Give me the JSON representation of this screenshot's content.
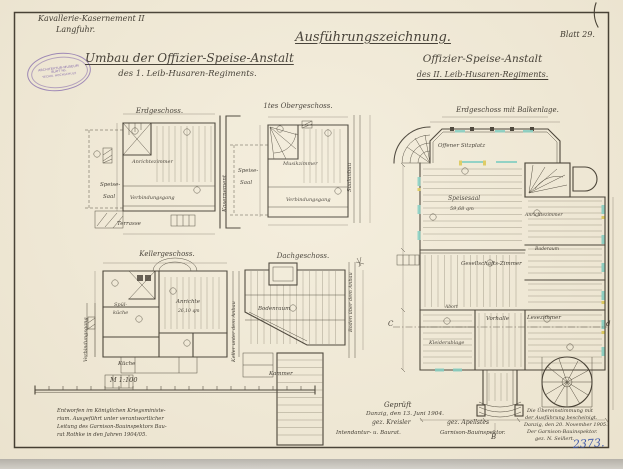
{
  "sheet": {
    "header": {
      "project_line1": "Kavallerie-Kasernement II",
      "project_line2": "Langfuhr.",
      "title_left_line1": "Umbau der Offizier-Speise-Anstalt",
      "title_left_line2": "des 1. Leib-Husaren-Regiments.",
      "main_title": "Ausführungszeichnung.",
      "title_right_line1": "Offizier-Speise-Anstalt",
      "title_right_line2": "des II. Leib-Husaren-Regiments.",
      "sheet_no": "Blatt 29."
    },
    "stamp": {
      "top": "ARCHITEKTUR-MUSEUM",
      "middle": "BLATT No.",
      "bottom": "TECHN. HOCHSCHULE"
    },
    "plans": {
      "erdgeschoss": {
        "title": "Erdgeschoss.",
        "room1a": "Speise-",
        "room1b": "Saal",
        "room2": "Anrichtezimmer",
        "room3": "Verbindungsgang",
        "room4": "Terrasse",
        "side_right": "Kasernement"
      },
      "obergeschoss": {
        "title": "1tes Obergeschoss.",
        "room1a": "Speise-",
        "room1b": "Saal",
        "room2": "Musikzimmer",
        "room3": "Verbindungsgang",
        "side_right": "Saalanbau"
      },
      "kellergeschoss": {
        "title": "Kellergeschoss.",
        "room1": "Anrichte",
        "room1_area": "26,10 qm",
        "room2a": "Spül-",
        "room2b": "küche",
        "room3": "Küche",
        "side_left": "Verbindungsgang",
        "side_right": "Keller unter dem Anbau"
      },
      "dachgeschoss": {
        "title": "Dachgeschoss.",
        "room1": "Bodenraum",
        "room2": "Kammer",
        "side_right": "Boden über dem Anbau"
      },
      "hauptplan": {
        "title": "Erdgeschoss mit Balkenlage.",
        "terrace": "Offener Sitzplatz",
        "hall": "Speisesaal",
        "hall_area": "59,68 qm",
        "room_social": "Gesellschafts-Zimmer",
        "room_vestibule": "Vorhalle",
        "room_reading": "Lesezimmer",
        "room_cloak": "Kleiderablage",
        "room_wc": "Abort",
        "room_serving": "Anrichtezimmer",
        "room_bath": "Baderaum",
        "section_c": "C",
        "section_d": "d",
        "section_b": "B"
      }
    },
    "scale_label": "M 1:100",
    "notes": {
      "designed_l1": "Entworfen im Königlichen Kriegsministe-",
      "designed_l2": "rium. Ausgeführt unter verantwortlicher",
      "designed_l3": "Leitung des Garnison-Bauinspektors Bau-",
      "designed_l4": "rat Rothke in den Jahren 1904/05.",
      "checked_title": "Geprüft",
      "checked_date": "Danzig, den 13. Juni 1904.",
      "sig1": "gez. Kreisler",
      "sig1_role": "Intendantur- u. Baurat.",
      "sig2": "gez. Apellstes",
      "sig2_role": "Garnison-Bauinspektor.",
      "cert_l1": "Die Übereinstimmung mit",
      "cert_l2": "der Ausführung bescheinigt.",
      "cert_l3": "Danzig, den 20. November 1905.",
      "cert_l4": "Der Garnison-Bauinspektor.",
      "cert_l5": "gez. N. Seillert."
    },
    "archive_no": "2373."
  }
}
